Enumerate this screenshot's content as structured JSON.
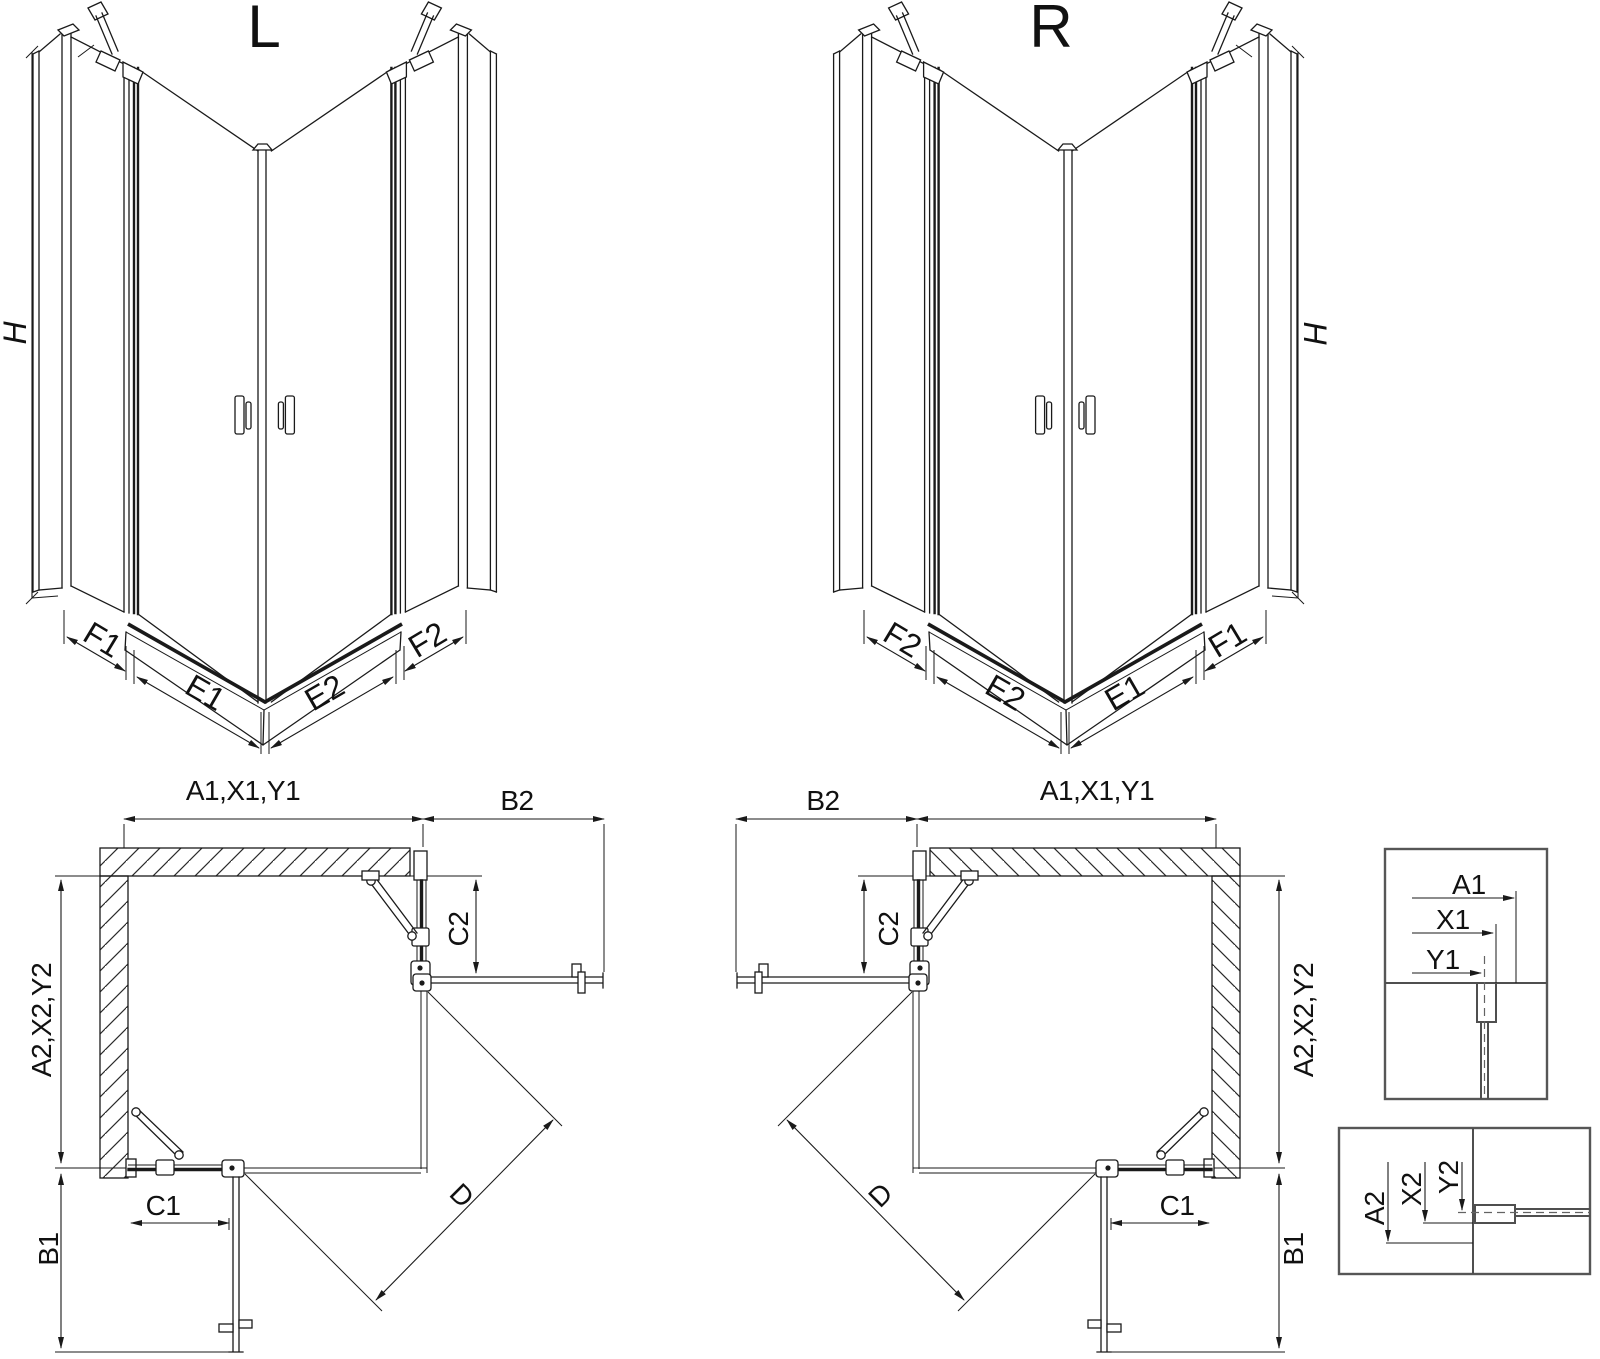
{
  "page": {
    "background": "#ffffff",
    "line_color": "#1a1a1a",
    "detail_line_color": "#4f4f4f"
  },
  "iso_views": {
    "left": {
      "title": "L",
      "height": "H",
      "segments": {
        "f1": "F1",
        "e1": "E1",
        "e2": "E2",
        "f2": "F2"
      }
    },
    "right": {
      "title": "R",
      "height": "H",
      "segments": {
        "f2": "F2",
        "e2": "E2",
        "e1": "E1",
        "f1": "F1"
      }
    }
  },
  "plan_views": {
    "left": {
      "width_label": "A1,X1,Y1",
      "door_top_label": "B2",
      "fixed_top_label": "C2",
      "depth_label": "A2,X2,Y2",
      "fixed_bottom_label": "C1",
      "door_bottom_label": "B1",
      "diagonal_label": "D"
    },
    "right": {
      "width_label": "A1,X1,Y1",
      "door_top_label": "B2",
      "fixed_top_label": "C2",
      "depth_label": "A2,X2,Y2",
      "fixed_bottom_label": "C1",
      "door_bottom_label": "B1",
      "diagonal_label": "D"
    }
  },
  "details": {
    "vertical_section": {
      "a1": "A1",
      "x1": "X1",
      "y1": "Y1"
    },
    "horizontal_section": {
      "a2": "A2",
      "x2": "X2",
      "y2": "Y2"
    }
  }
}
